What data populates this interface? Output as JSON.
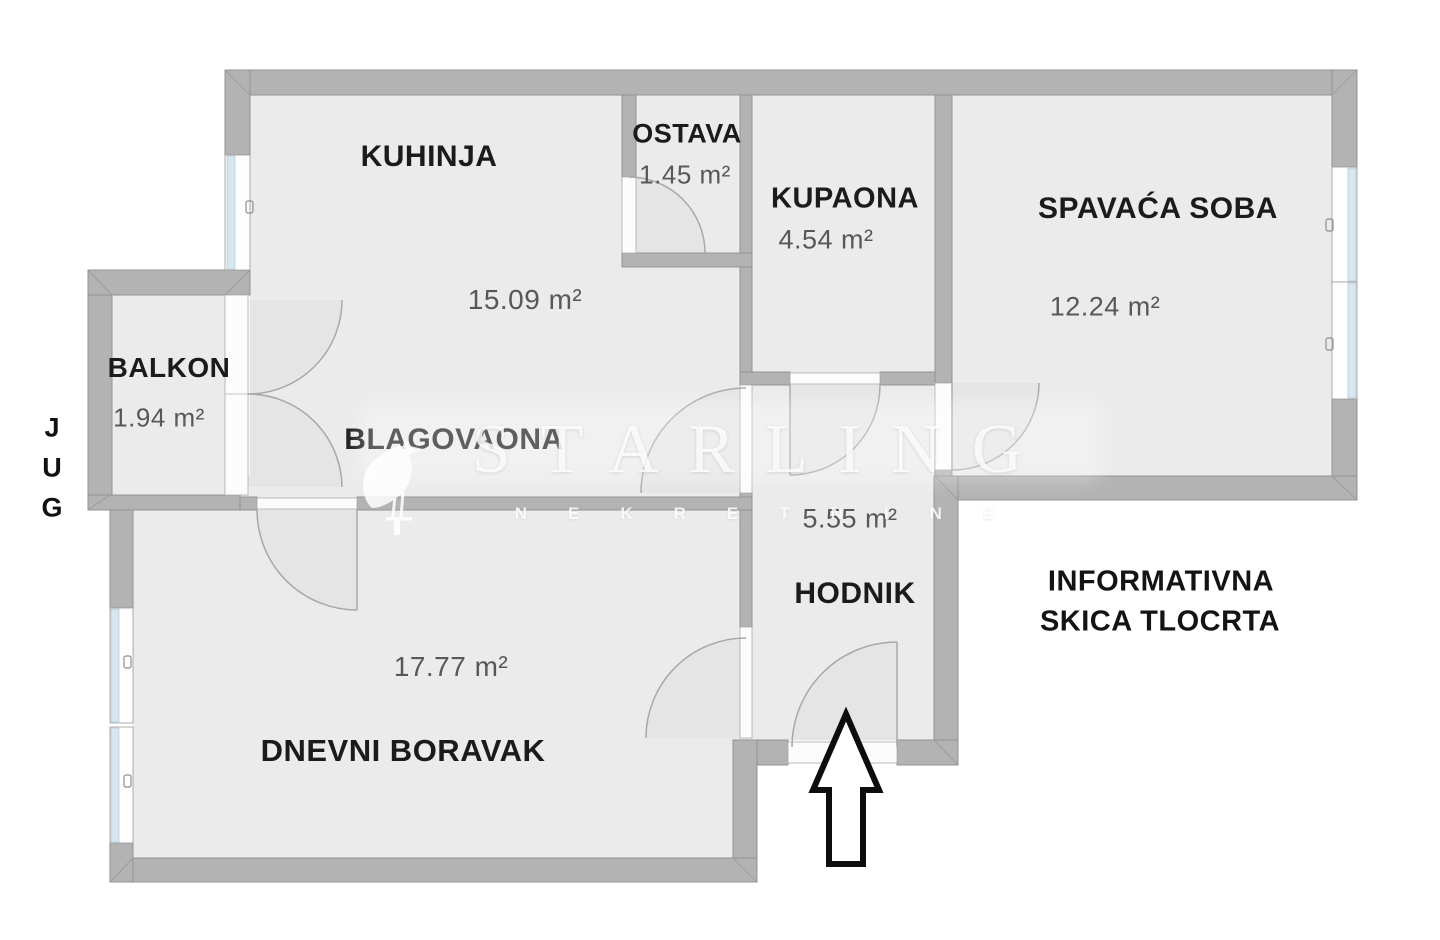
{
  "plan": {
    "type": "floor-plan",
    "disclaimer": {
      "line1": "INFORMATIVNA",
      "line2": "SKICA TLOCRTA"
    },
    "compass": {
      "direction": "JUG",
      "letters": [
        "J",
        "U",
        "G"
      ]
    }
  },
  "rooms": {
    "kuhinja": {
      "name": "KUHINJA",
      "area": "15.09 m²"
    },
    "ostava": {
      "name": "OSTAVA",
      "area": "1.45 m²"
    },
    "kupaona": {
      "name": "KUPAONA",
      "area": "4.54 m²"
    },
    "spavaca_soba": {
      "name": "SPAVAĆA SOBA",
      "area": "12.24 m²"
    },
    "balkon": {
      "name": "BALKON",
      "area": "1.94 m²"
    },
    "blagovaona": {
      "name": "BLAGOVAONA"
    },
    "hodnik": {
      "name": "HODNIK",
      "area": "5.55 m²"
    },
    "dnevni_boravak": {
      "name": "DNEVNI BORAVAK",
      "area": "17.77 m²"
    }
  },
  "watermark": {
    "brand": "STARLING",
    "subtitle": "NEKRETNINE"
  },
  "icons": {
    "entrance_arrow": "outlined up-arrow polygon marking the apartment entrance",
    "starling_bird": "white bird silhouette, part of watermark logo"
  },
  "colors": {
    "background": "#ffffff",
    "floor": "#ebebeb",
    "wall": "#b3b3b3",
    "wall_edge": "#939393",
    "window_glass": "#d6e7f0",
    "door_arc": "#a8a8a8",
    "room_label": "#1b1b1b",
    "area_label": "#585858",
    "watermark": "#ffffff",
    "arrow_stroke": "#0d0d0d"
  }
}
